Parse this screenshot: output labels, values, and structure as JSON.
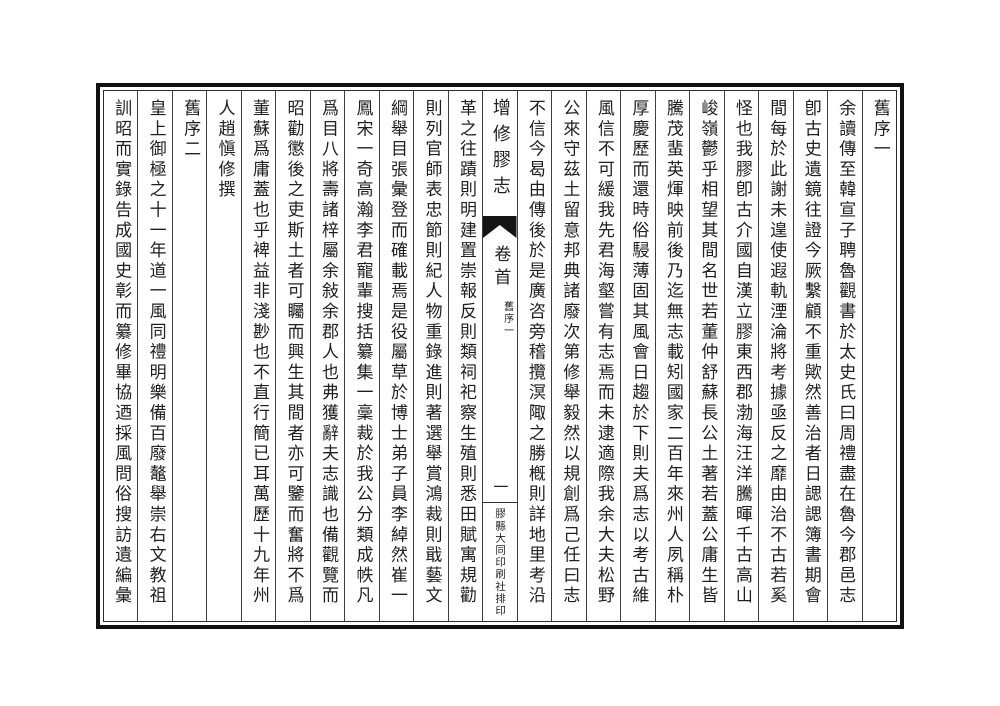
{
  "book": {
    "center": {
      "title": "增修膠志",
      "section": "卷首",
      "subsection": "舊序一",
      "page_number": "一",
      "printer": "膠縣大同印刷社排印"
    },
    "right_columns": [
      "舊序一",
      "余讀傳至韓宣子聘魯觀書於太史氏曰周禮盡在魯今郡邑志",
      "卽古史遺鏡往證今厥繫顧不重歟然善治者日諰諰簿書期會",
      "間每於此謝未遑使遐軌湮淪將考據亟反之靡由治不古若奚",
      "怪也我膠卽古介國自漢立膠東西郡渤海汪洋騰暉千古高山",
      "峻嶺鬱乎相望其間名世若董仲舒蘇長公土著若蓋公庸生皆",
      "騰茂蜚英煇映前後乃迄無志載矧國家二百年來州人夙稱朴",
      "厚慶歷而還時俗駸薄固其風會日趨於下則夫爲志以考古維",
      "風信不可緩我先君海壑嘗有志焉而未逮適際我余大夫松野",
      "公來守茲土留意邦典諸廢次第修舉毅然以規創爲己任曰志",
      "不信今曷由傳後於是廣咨旁稽攬溟陬之勝槪則詳地里考沿"
    ],
    "left_columns": [
      "革之往蹟則明建置崇報反則類祠祀察生殖則悉田賦寓規勸",
      "則列官師表忠節則紀人物重錄進則著選舉賞鴻裁則戢藝文",
      "綱舉目張彙登而確載焉是役屬草於博士弟子員李綽然崔一",
      "鳳宋一奇高瀚李君寵輩搜括纂集一稾裁於我公分類成帙凡",
      "爲目八將壽諸梓屬余敍余郡人也弗獲辭夫志識也備觀覽而",
      "昭勸懲後之吏斯土者可矚而興生其間者亦可鑒而奮將不爲",
      "董蘇爲庸蓋也乎裨益非淺尠也不直行簡已耳萬歷十九年州",
      "人趙愼修撰",
      "舊序二",
      "皇上御極之十一年道一風同禮明樂備百廢鼇舉崇右文教祖",
      "訓昭而實錄告成國史彰而纂修畢協迺採風問俗搜訪遺編彙"
    ],
    "colors": {
      "ink": "#1f1f1f",
      "frame": "#101010",
      "paper": "#ffffff"
    }
  }
}
